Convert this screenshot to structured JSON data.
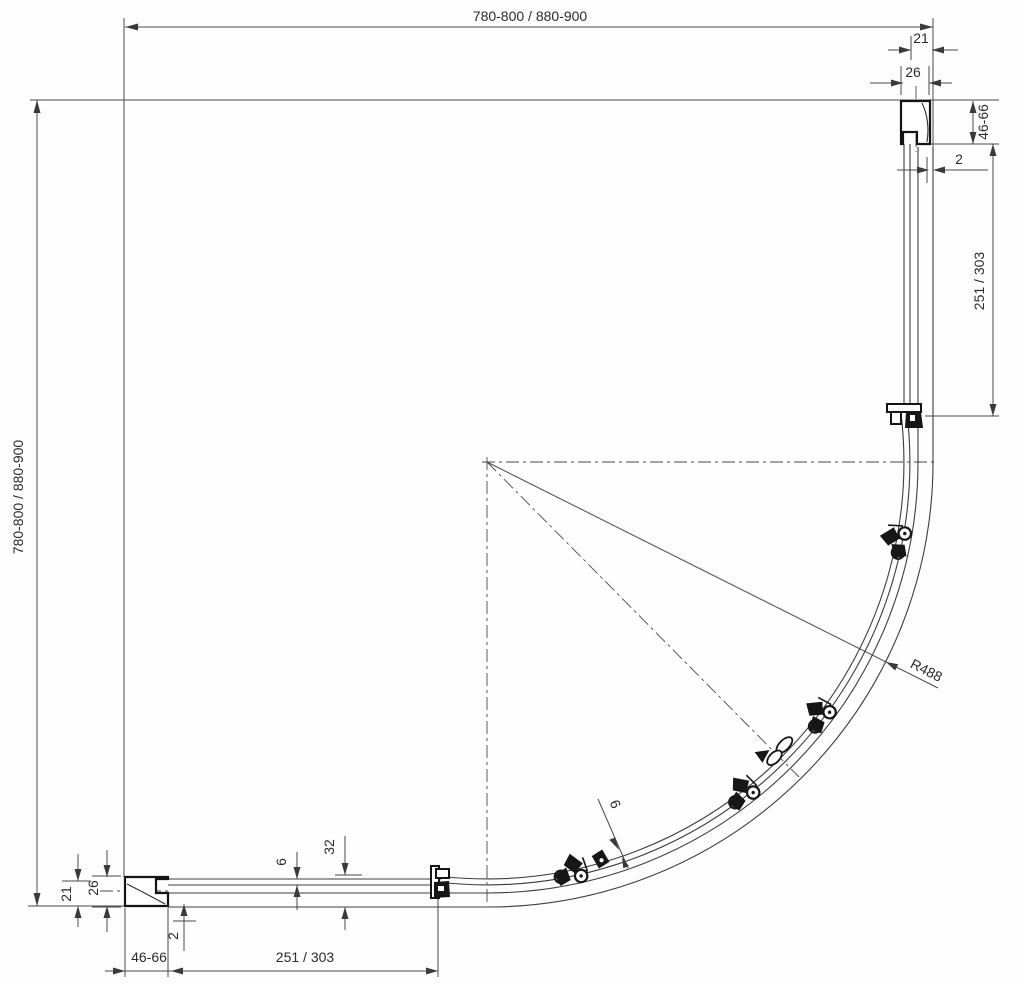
{
  "drawing": {
    "kind": "shower-enclosure-plan",
    "dims": {
      "top_width": "780-800 / 880-900",
      "left_height": "780-800 / 880-900",
      "top_21": "21",
      "top_26": "26",
      "top_46_66": "46-66",
      "top_2": "2",
      "right_251_303": "251 / 303",
      "radius_r488": "R488",
      "arc_glass_6": "6",
      "bottom_32": "32",
      "bottom_6": "6",
      "bottom_2": "2",
      "bottom_21": "21",
      "bottom_26": "26",
      "bottom_46_66": "46-66",
      "bottom_251_303": "251 / 303"
    },
    "line_color": "#4a4a4a",
    "profile_color": "#141414"
  }
}
